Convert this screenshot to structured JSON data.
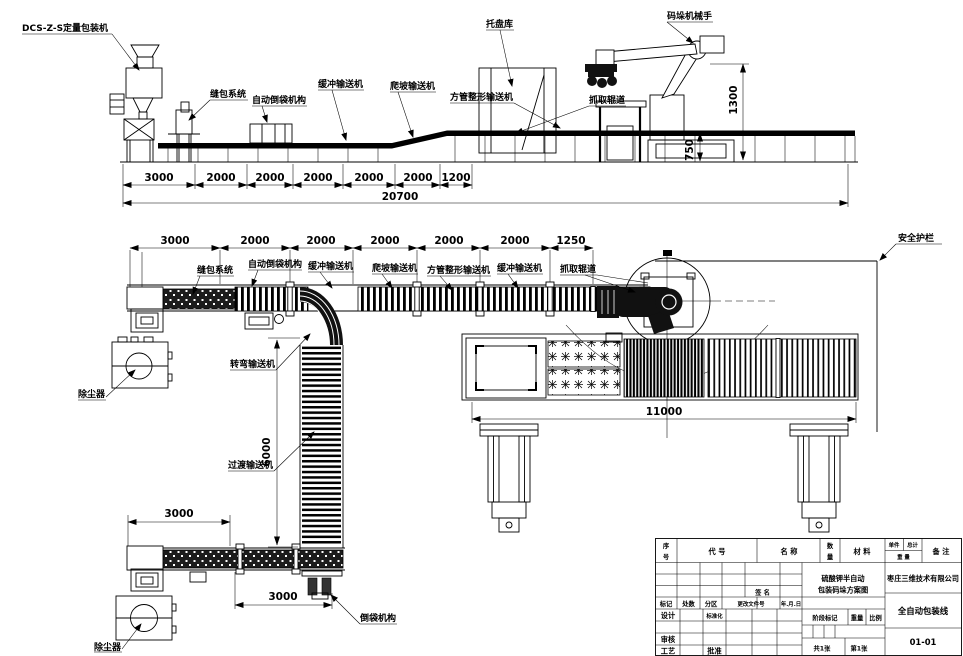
{
  "top_view": {
    "labels": {
      "packer": "DCS-Z-S定量包装机",
      "sewing": "缝包系统",
      "bag_flip": "自动倒袋机构",
      "buffer": "缓冲输送机",
      "incline": "爬坡输送机",
      "shaping": "方管整形输送机",
      "pallet_store": "托盘库",
      "robot": "码垛机械手",
      "grab": "抓取辊道"
    },
    "dims": {
      "segments": [
        "3000",
        "2000",
        "2000",
        "2000",
        "2000",
        "2000",
        "1200"
      ],
      "total": "20700",
      "robot_height": "1300",
      "conveyor_height": "750"
    }
  },
  "plan_view": {
    "labels": {
      "sewing": "缝包系统",
      "bag_flip": "自动倒袋机构",
      "buffer1": "缓冲输送机",
      "incline": "爬坡输送机",
      "shaping": "方管整形输送机",
      "buffer2": "缓冲输送机",
      "grab": "抓取辊道",
      "fence": "安全护栏",
      "turn": "转弯输送机",
      "transition": "过渡输送机",
      "dust_upper": "除尘器",
      "dust_lower": "除尘器",
      "bag_flip2": "倒袋机构"
    },
    "dims": {
      "segments": [
        "3000",
        "2000",
        "2000",
        "2000",
        "2000",
        "2000",
        "1250"
      ],
      "drop": "6000",
      "branch_upper": "3000",
      "branch_lower": "3000",
      "pallet_line": "11000"
    }
  },
  "title_block": {
    "headers": {
      "no_1": "序",
      "no_2": "号",
      "code": "代 号",
      "name": "名 称",
      "qty_1": "数",
      "qty_2": "量",
      "material": "材 料",
      "unit": "单件",
      "total": "总计",
      "weight": "重 量",
      "remark": "备 注"
    },
    "sign": "签 名",
    "revision": {
      "mark": "标记",
      "count": "处数",
      "zone": "分区",
      "doc": "更改文件号",
      "date": "年.月.日"
    },
    "roles": {
      "design": "设计",
      "standard": "标准化",
      "check": "审核",
      "craft": "工艺",
      "approve": "批准"
    },
    "stage": {
      "mark": "阶段标记",
      "weight": "重量",
      "scale": "比例"
    },
    "sheets": {
      "total": "共1张",
      "current": "第1张"
    },
    "title_line1": "硫酸钾半自动",
    "title_line2": "包装码垛方案图",
    "company": "枣庄三维技术有限公司",
    "product": "全自动包装线",
    "drawing_no": "01-01"
  }
}
